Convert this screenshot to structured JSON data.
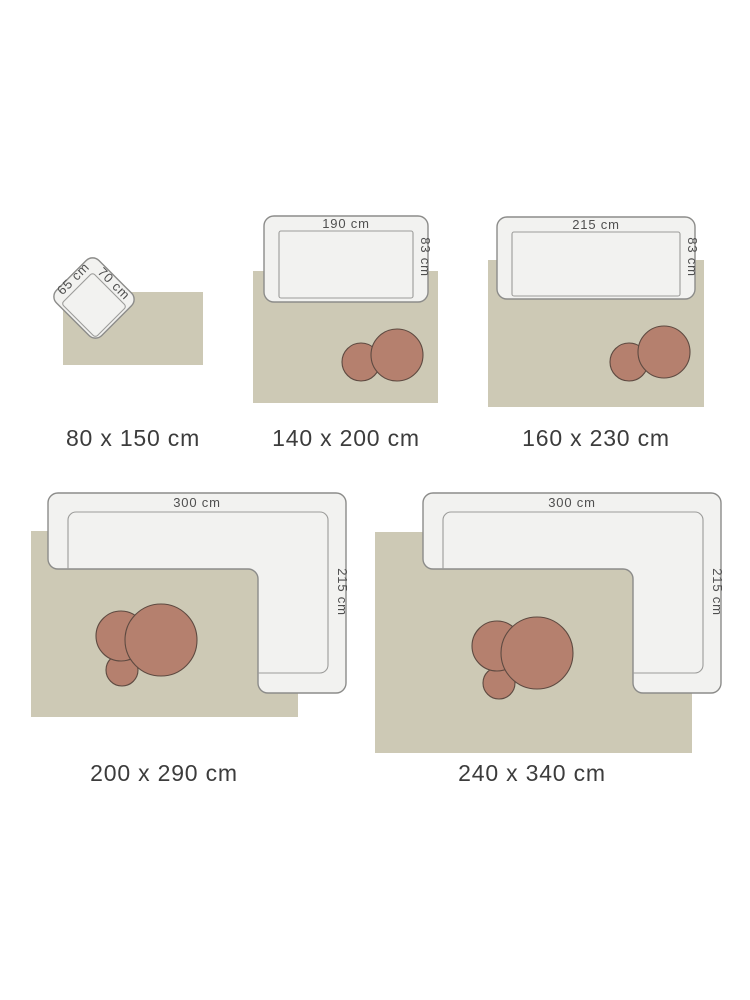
{
  "title": "Rug size guide with furniture for scale",
  "colors": {
    "background": "#ffffff",
    "rug": "#cdc9b5",
    "sofa-fill": "#f2f2f0",
    "sofa-stroke": "#8c8c8a",
    "inner-stroke": "#9c9c9a",
    "table-fill": "#b5806e",
    "table-stroke": "#5e4a41",
    "caption": "#3c3c3c",
    "dimension": "#4f4f4f"
  },
  "panels": [
    {
      "caption": "80 x 150 cm",
      "furniture": "armchair",
      "coffee_tables": 0,
      "labels": {
        "width": "65 cm",
        "depth": "70 cm"
      }
    },
    {
      "caption": "140 x 200 cm",
      "furniture": "sofa",
      "coffee_tables": 2,
      "labels": {
        "width": "190 cm",
        "depth": "83 cm"
      }
    },
    {
      "caption": "160 x 230 cm",
      "furniture": "sofa",
      "coffee_tables": 2,
      "labels": {
        "width": "215 cm",
        "depth": "83 cm"
      }
    },
    {
      "caption": "200 x 290 cm",
      "furniture": "corner-sofa",
      "coffee_tables": 3,
      "labels": {
        "width": "300 cm",
        "depth": "215 cm"
      }
    },
    {
      "caption": "240 x 340 cm",
      "furniture": "corner-sofa",
      "coffee_tables": 3,
      "labels": {
        "width": "300 cm",
        "depth": "215 cm"
      }
    }
  ]
}
